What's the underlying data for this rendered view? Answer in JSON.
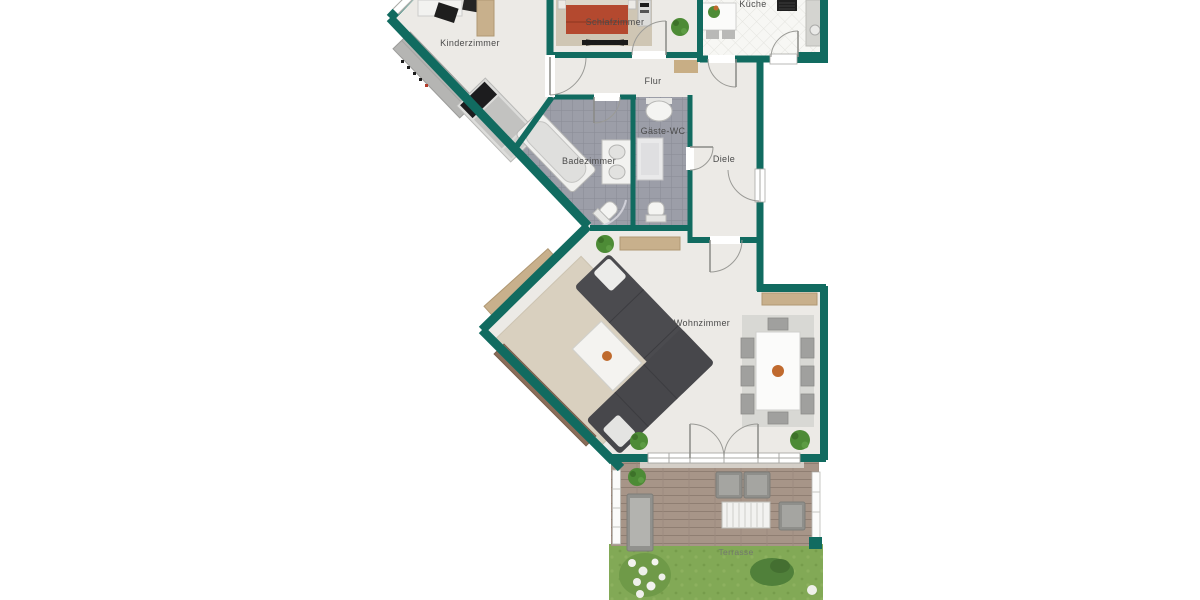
{
  "plan": {
    "type": "apartment-floorplan",
    "labels": {
      "kinderzimmer": "Kinderzimmer",
      "schlafzimmer": "Schlafzimmer",
      "kueche": "Küche",
      "flur": "Flur",
      "badezimmer": "Badezimmer",
      "gaeste_wc": "Gäste-WC",
      "diele": "Diele",
      "wohnzimmer": "Wohnzimmer",
      "terrasse": "Terrasse"
    },
    "colors": {
      "wall": "#116b60",
      "floor": "#eceae6",
      "bath_tile": "#9c9ea8",
      "kitchen_floor": "#f7f7f4",
      "deck_wood": "#a79588",
      "grass": "#82a956",
      "bed_red": "#b4492f",
      "sofa_gray": "#4b4b4f",
      "rug_beige": "#d9d0bf",
      "sideboard_tan": "#c8b08c",
      "sideboard_brown": "#8a6c58"
    }
  }
}
